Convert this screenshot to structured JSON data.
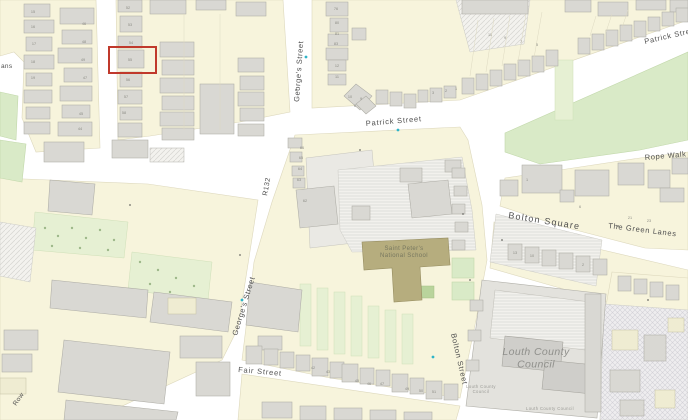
{
  "map": {
    "title": "Street map with highlighted property",
    "colors": {
      "road": "#ffffff",
      "parcel": "#f7f4dc",
      "building": "#d9d8d3",
      "green": "#d9eac7",
      "school": "#b6ad7e",
      "highlight": "#c0392b",
      "street_text": "#4f4f4f",
      "marker": "#2fb4c8"
    },
    "highlight": {
      "x": 109,
      "y": 47,
      "width": 47,
      "height": 26,
      "color": "#c0392b",
      "stroke_width": 2
    },
    "streets": [
      {
        "id": "georges-street-n",
        "label": "George's Street",
        "x": 299,
        "y": 102,
        "rotation": -86,
        "size": 7.5,
        "spacing": 0.6
      },
      {
        "id": "patrick-street-mid",
        "label": "Patrick Street",
        "x": 366,
        "y": 126,
        "rotation": -5,
        "size": 7.5,
        "spacing": 0.8
      },
      {
        "id": "patrick-street-ne",
        "label": "Patrick Street",
        "x": 645,
        "y": 44,
        "rotation": -13,
        "size": 7.5,
        "spacing": 0.7
      },
      {
        "id": "rope-walk",
        "label": "Rope Walk",
        "x": 645,
        "y": 160,
        "rotation": -5,
        "size": 7.5,
        "spacing": 0.6
      },
      {
        "id": "r132",
        "label": "R132",
        "x": 267,
        "y": 196,
        "rotation": -80,
        "size": 7,
        "spacing": 0.4
      },
      {
        "id": "bolton-square",
        "label": "Bolton Square",
        "x": 508,
        "y": 218,
        "rotation": 9,
        "size": 9,
        "spacing": 1.2
      },
      {
        "id": "the-green-lanes",
        "label": "The Green Lanes",
        "x": 608,
        "y": 228,
        "rotation": 7,
        "size": 7.5,
        "spacing": 0.7
      },
      {
        "id": "georges-street-s",
        "label": "George's Street",
        "x": 237,
        "y": 336,
        "rotation": -73,
        "size": 7.5,
        "spacing": 0.6
      },
      {
        "id": "fair-street",
        "label": "Fair Street",
        "x": 238,
        "y": 372,
        "rotation": 5,
        "size": 7.5,
        "spacing": 0.8
      },
      {
        "id": "bolton-street",
        "label": "Bolton Street",
        "x": 451,
        "y": 334,
        "rotation": 77,
        "size": 7.5,
        "spacing": 0.7
      },
      {
        "id": "row-partial",
        "label": "Row",
        "x": 16,
        "y": 406,
        "rotation": -55,
        "size": 6.5,
        "spacing": 0.4
      },
      {
        "id": "ans-partial",
        "label": "ans",
        "x": 1,
        "y": 68,
        "rotation": 0,
        "size": 6.5,
        "spacing": 0.3
      }
    ],
    "places": [
      {
        "id": "school-label",
        "lines": [
          "Saint Peter's",
          "National School"
        ],
        "x": 404,
        "y": 250,
        "size": 6,
        "color": "#77775f",
        "italic": false
      },
      {
        "id": "council-label-main",
        "lines": [
          "Louth County",
          "Council"
        ],
        "x": 536,
        "y": 355,
        "size": 10.5,
        "color": "#90908c",
        "italic": true
      },
      {
        "id": "council-label-small-1",
        "lines": [
          "Louth County",
          "Council"
        ],
        "x": 481,
        "y": 388,
        "size": 4.2,
        "color": "#9b9b96",
        "italic": false
      },
      {
        "id": "council-label-small-2",
        "lines": [
          "Louth County Council"
        ],
        "x": 550,
        "y": 410,
        "size": 4.2,
        "color": "#9b9b96",
        "italic": false
      }
    ],
    "house_numbers": [
      {
        "n": "15",
        "x": 33,
        "y": 13
      },
      {
        "n": "16",
        "x": 33,
        "y": 28
      },
      {
        "n": "17",
        "x": 34,
        "y": 45
      },
      {
        "n": "18",
        "x": 33,
        "y": 63
      },
      {
        "n": "19",
        "x": 33,
        "y": 79
      },
      {
        "n": "46",
        "x": 84,
        "y": 25
      },
      {
        "n": "48",
        "x": 84,
        "y": 43
      },
      {
        "n": "49",
        "x": 83,
        "y": 61
      },
      {
        "n": "47",
        "x": 85,
        "y": 79
      },
      {
        "n": "45",
        "x": 81,
        "y": 115
      },
      {
        "n": "44",
        "x": 80,
        "y": 130
      },
      {
        "n": "52",
        "x": 128,
        "y": 9
      },
      {
        "n": "53",
        "x": 130,
        "y": 26
      },
      {
        "n": "54",
        "x": 131,
        "y": 44
      },
      {
        "n": "55",
        "x": 130,
        "y": 61
      },
      {
        "n": "56",
        "x": 128,
        "y": 81
      },
      {
        "n": "57",
        "x": 126,
        "y": 98
      },
      {
        "n": "58",
        "x": 124,
        "y": 114
      },
      {
        "n": "76",
        "x": 336,
        "y": 10
      },
      {
        "n": "80",
        "x": 337,
        "y": 24
      },
      {
        "n": "81",
        "x": 337,
        "y": 35
      },
      {
        "n": "83",
        "x": 336,
        "y": 45
      },
      {
        "n": "12",
        "x": 337,
        "y": 67
      },
      {
        "n": "11",
        "x": 337,
        "y": 78
      },
      {
        "n": "10",
        "x": 350,
        "y": 98
      },
      {
        "n": "9",
        "x": 361,
        "y": 100
      },
      {
        "n": "8",
        "x": 355,
        "y": 107
      },
      {
        "n": "3",
        "x": 433,
        "y": 94
      },
      {
        "n": "2",
        "x": 446,
        "y": 92
      },
      {
        "n": "1",
        "x": 456,
        "y": 90
      },
      {
        "n": "66",
        "x": 302,
        "y": 149
      },
      {
        "n": "65",
        "x": 301,
        "y": 159
      },
      {
        "n": "64",
        "x": 300,
        "y": 170
      },
      {
        "n": "63",
        "x": 299,
        "y": 181
      },
      {
        "n": "62",
        "x": 305,
        "y": 202
      },
      {
        "n": "11",
        "x": 490,
        "y": 36
      },
      {
        "n": "9",
        "x": 505,
        "y": 39
      },
      {
        "n": "7",
        "x": 521,
        "y": 43
      },
      {
        "n": "5",
        "x": 537,
        "y": 46
      },
      {
        "n": "42",
        "x": 313,
        "y": 369
      },
      {
        "n": "43",
        "x": 328,
        "y": 373
      },
      {
        "n": "45",
        "x": 357,
        "y": 382
      },
      {
        "n": "46",
        "x": 369,
        "y": 385
      },
      {
        "n": "47",
        "x": 382,
        "y": 385
      },
      {
        "n": "49",
        "x": 407,
        "y": 390
      },
      {
        "n": "50",
        "x": 421,
        "y": 392
      },
      {
        "n": "51",
        "x": 434,
        "y": 393
      },
      {
        "n": "1",
        "x": 527,
        "y": 181
      },
      {
        "n": "6",
        "x": 580,
        "y": 208
      },
      {
        "n": "21",
        "x": 630,
        "y": 219
      },
      {
        "n": "23",
        "x": 649,
        "y": 222
      },
      {
        "n": "13",
        "x": 515,
        "y": 254
      },
      {
        "n": "10",
        "x": 532,
        "y": 257
      },
      {
        "n": "2",
        "x": 583,
        "y": 266
      }
    ],
    "markers": [
      {
        "x": 306,
        "y": 57
      },
      {
        "x": 398,
        "y": 130
      },
      {
        "x": 433,
        "y": 357
      },
      {
        "x": 242,
        "y": 300
      }
    ]
  }
}
